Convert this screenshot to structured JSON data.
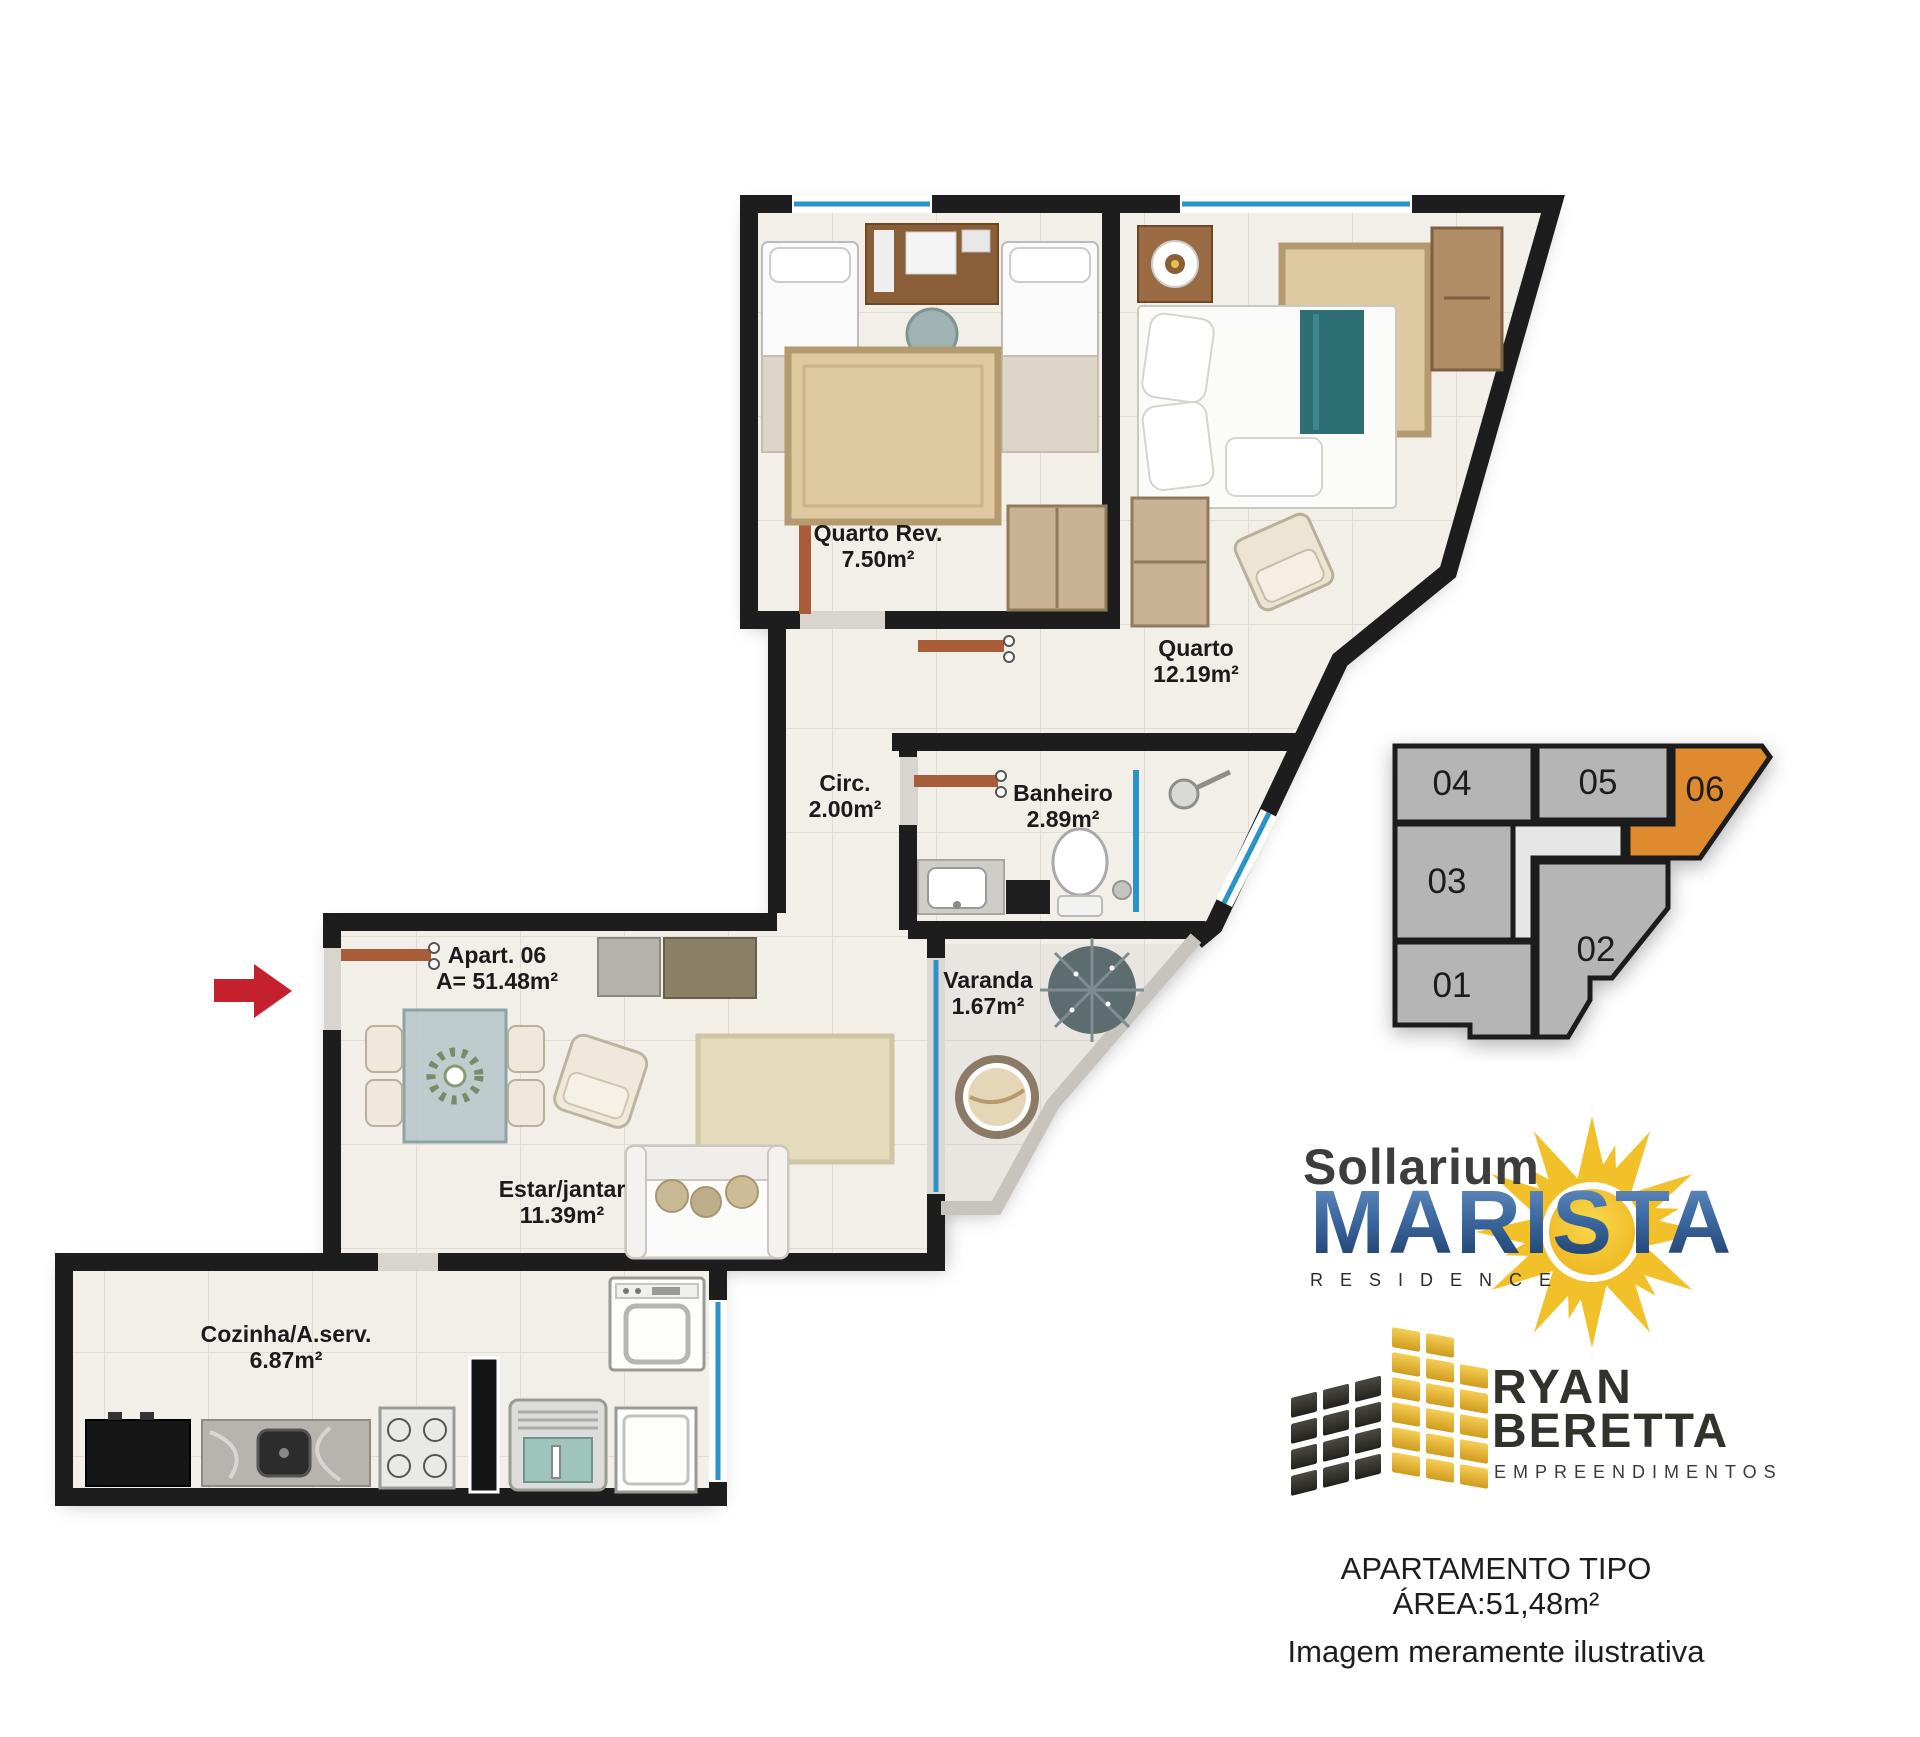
{
  "plan": {
    "rooms": [
      {
        "name": "Quarto Rev.",
        "area": "7.50m²"
      },
      {
        "name": "Quarto",
        "area": "12.19m²"
      },
      {
        "name": "Circ.",
        "area": "2.00m²"
      },
      {
        "name": "Banheiro",
        "area": "2.89m²"
      },
      {
        "name": "Apart. 06",
        "area": "A= 51.48m²"
      },
      {
        "name": "Varanda",
        "area": "1.67m²"
      },
      {
        "name": "Estar/jantar",
        "area": "11.39m²"
      },
      {
        "name": "Cozinha/A.serv.",
        "area": "6.87m²"
      }
    ]
  },
  "keyplan": {
    "units": [
      {
        "number": "04",
        "highlighted": false
      },
      {
        "number": "05",
        "highlighted": false
      },
      {
        "number": "06",
        "highlighted": true
      },
      {
        "number": "03",
        "highlighted": false
      },
      {
        "number": "02",
        "highlighted": false
      },
      {
        "number": "01",
        "highlighted": false
      }
    ]
  },
  "brand": {
    "name_top": "Sollarium",
    "name_main": "MARISTA",
    "name_sub": "RESIDENCE"
  },
  "developer": {
    "line1": "RYAN",
    "line2": "BERETTA",
    "line3": "EMPREENDIMENTOS"
  },
  "caption": {
    "line1": "APARTAMENTO TIPO",
    "line2": "ÁREA:51,48m²",
    "line3": "Imagem meramente ilustrativa"
  },
  "colors": {
    "wall": "#1d1d1d",
    "floor": "#f2efe9",
    "glass_blue": "#2a93c9",
    "door_wood": "#a85c38",
    "unit_highlight": "#de8a2f",
    "unit_gray": "#b5b5b5",
    "sun_yellow": "#f2c028",
    "marista_blue": "#2c5a94",
    "logo_gold": "#e2a92f",
    "arrow_red": "#c4202e"
  }
}
